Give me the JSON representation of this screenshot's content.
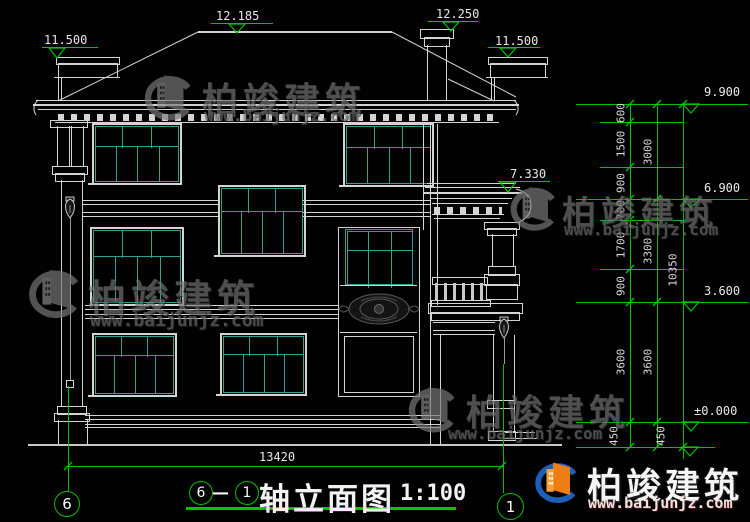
{
  "watermark": {
    "brand": "柏竣建筑",
    "url": "www.baijunjz.com"
  },
  "title": {
    "axis_start": "6",
    "separator": "—",
    "axis_end": "1",
    "name": "轴立面图",
    "scale": "1:100"
  },
  "axes": {
    "left_bubble": "6",
    "right_bubble": "1"
  },
  "dimensions": {
    "overall_width": "13420",
    "right_inner_chain": [
      "600",
      "1500",
      "900",
      "700",
      "1700",
      "900",
      "3600",
      "450"
    ],
    "right_middle_chain": [
      "3000",
      "3300",
      "3600",
      "450"
    ],
    "right_outer_chain": [
      "10350"
    ]
  },
  "elevations": {
    "roof_left": "11.500",
    "ridge": "12.185",
    "chimney": "12.250",
    "roof_right": "11.500",
    "porch_roof": "7.330",
    "eave": "9.900",
    "floor3": "6.900",
    "floor2": "3.600",
    "ground": "±0.000"
  },
  "colors": {
    "background": "#000000",
    "line": "#d4d4d4",
    "mullion": "#2fa193",
    "dimension_green": "#00c400",
    "logo_orange": "#ef7d16",
    "logo_blue": "#1d5fb8"
  }
}
